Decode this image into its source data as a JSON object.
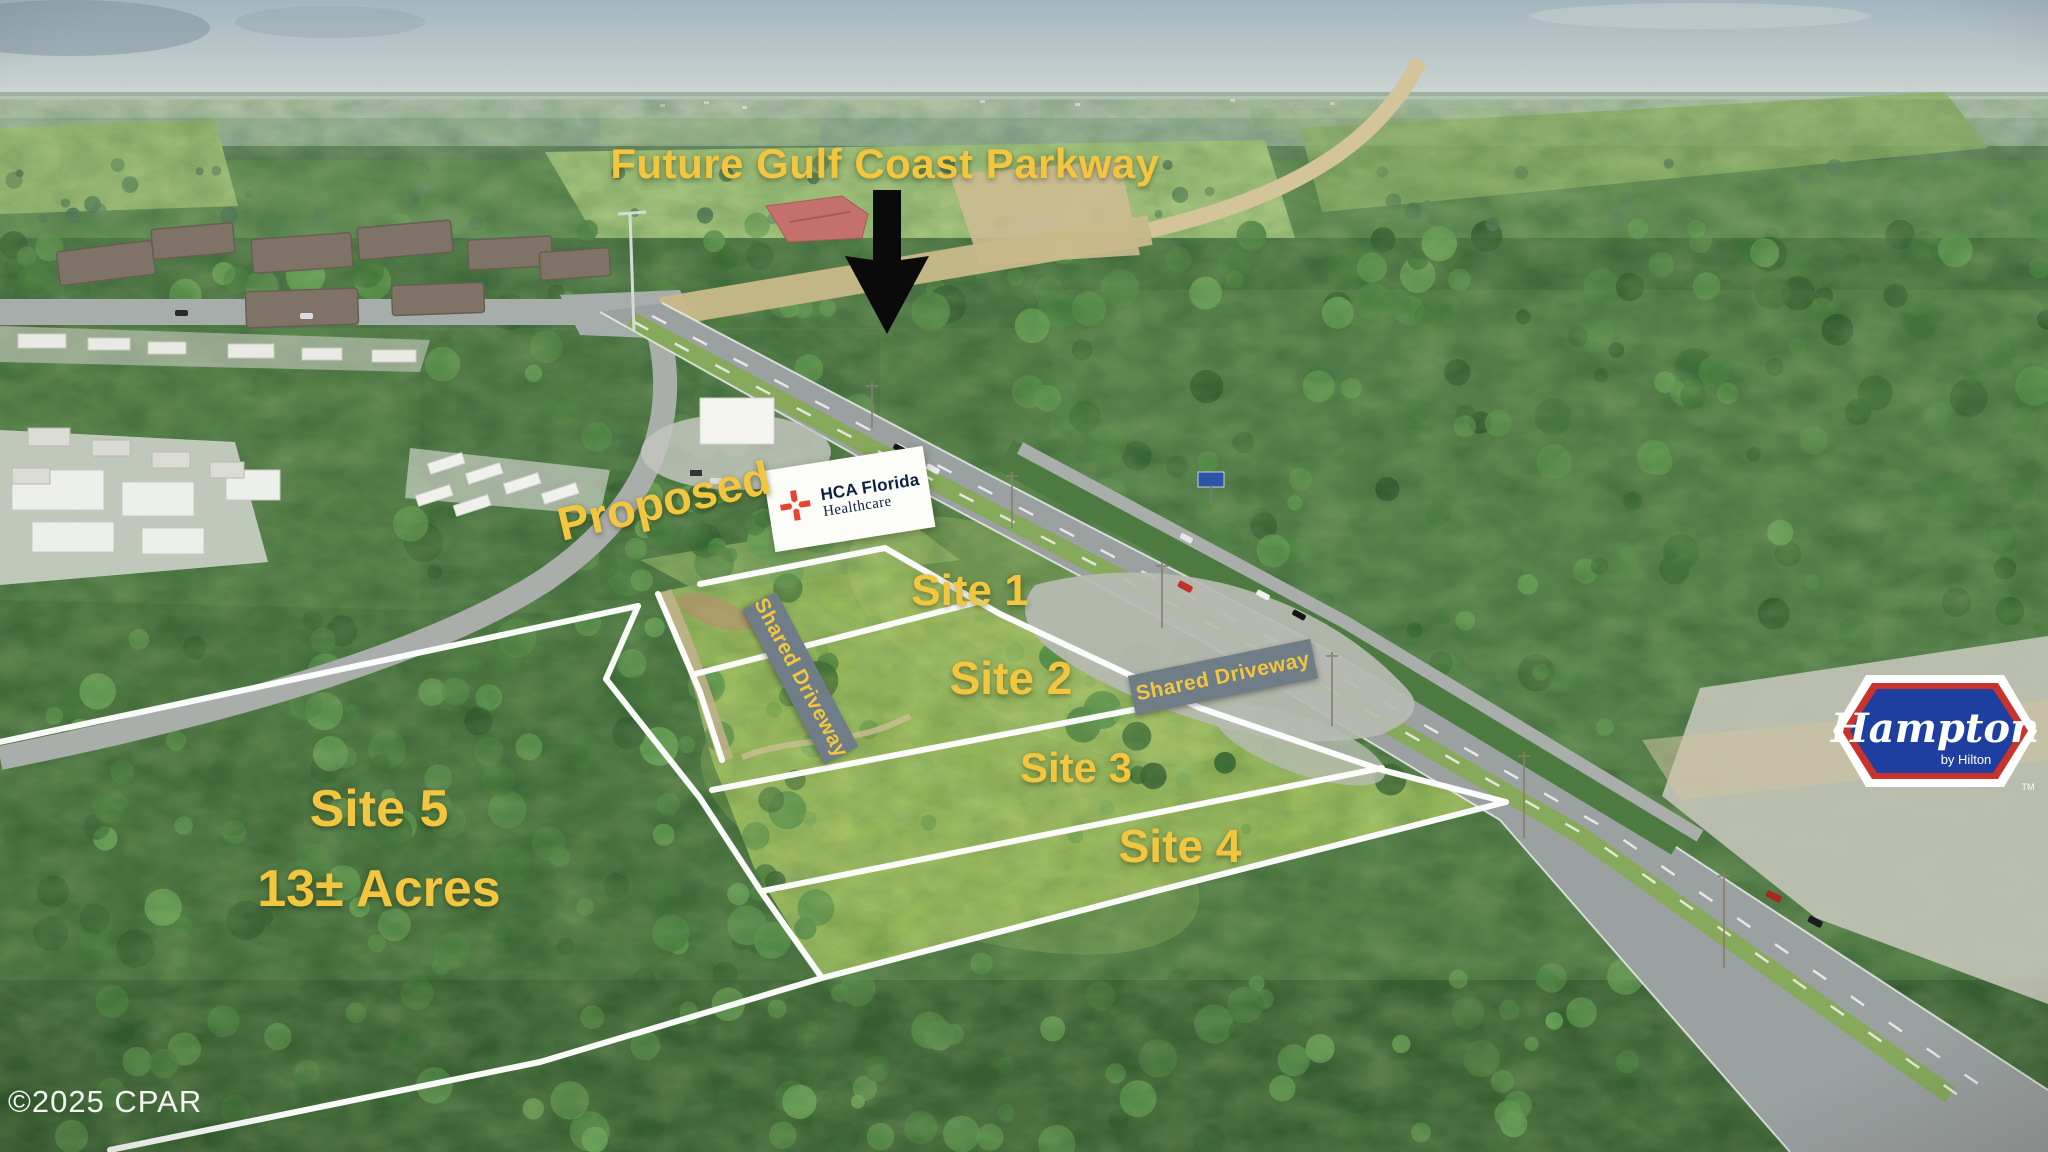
{
  "annotations": {
    "title": "Future Gulf Coast Parkway",
    "proposed_label": "Proposed",
    "sites": [
      {
        "label": "Site 1"
      },
      {
        "label": "Site 2"
      },
      {
        "label": "Site 3"
      },
      {
        "label": "Site 4"
      }
    ],
    "site5": {
      "name": "Site 5",
      "acreage": "13± Acres"
    },
    "shared_driveway_left": "Shared Driveway",
    "shared_driveway_right": "Shared Driveway"
  },
  "logos": {
    "hca": {
      "name_line": "HCA Florida",
      "sub_line": "Healthcare"
    },
    "hampton": {
      "brand": "Hampton",
      "byline": "by Hilton",
      "trademark": "TM"
    }
  },
  "watermark": "©2025 CPAR",
  "colors": {
    "label_yellow": "#F2C63E",
    "driveway_gray": "#6F7D86",
    "hca_red": "#E8432E",
    "hca_navy": "#0D2240",
    "hampton_blue": "#1E3FA0",
    "hampton_red": "#C8332E",
    "boundary_white": "#FFFFFF",
    "arrow_black": "#0A0A0A"
  }
}
